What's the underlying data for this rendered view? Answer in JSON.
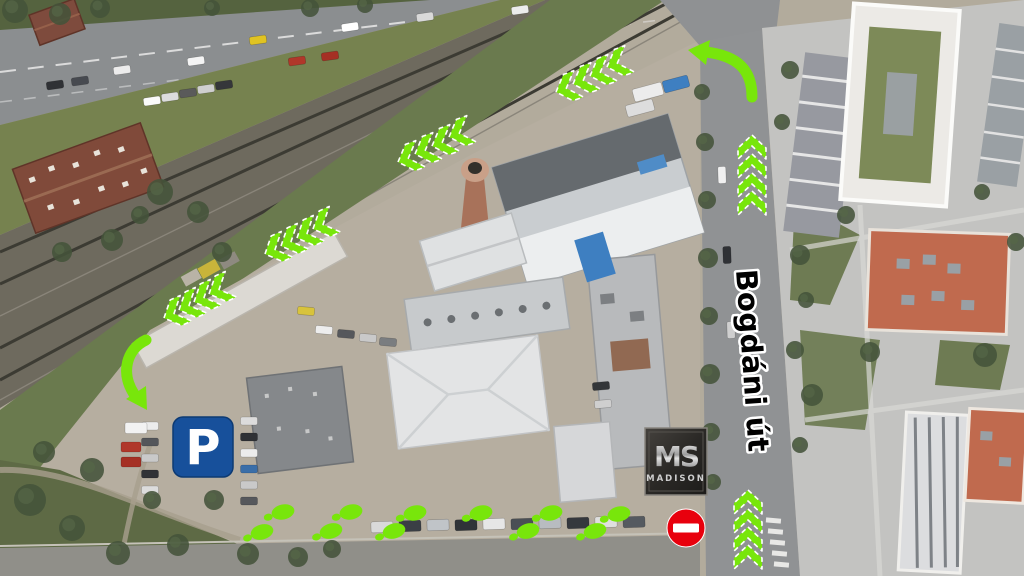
{
  "overlay": {
    "colors": {
      "route_green": "#78e60b",
      "parking_blue": "#17509b",
      "no_entry_red": "#e8000d",
      "street_label_fill": "#000000",
      "street_label_outline": "#ffffff",
      "logo_background": "#2e2c29"
    },
    "street_label": {
      "text": "Bogdáni út"
    },
    "parking_sign": {
      "symbol": "P"
    },
    "madison_logo": {
      "initials": "MS",
      "name": "MADISON"
    },
    "route": {
      "chevron_groups": [
        {
          "name": "railway-route-chevrons-1",
          "rotation": -20,
          "tips": [
            [
              556,
              92
            ],
            [
              573,
              84
            ],
            [
              590,
              76
            ],
            [
              607,
              67
            ]
          ]
        },
        {
          "name": "railway-route-chevrons-2",
          "rotation": -20,
          "tips": [
            [
              398,
              162
            ],
            [
              415,
              154
            ],
            [
              432,
              146
            ],
            [
              449,
              137
            ]
          ]
        },
        {
          "name": "railway-route-chevrons-3",
          "rotation": -24,
          "tips": [
            [
              265,
              254
            ],
            [
              281,
              246
            ],
            [
              297,
              238
            ],
            [
              313,
              229
            ]
          ]
        },
        {
          "name": "railway-route-chevrons-4",
          "rotation": -24,
          "tips": [
            [
              164,
              318
            ],
            [
              179,
              310
            ],
            [
              194,
              302
            ],
            [
              209,
              294
            ]
          ]
        },
        {
          "name": "bogdani-street-chevrons-north",
          "rotation": 90,
          "tips": [
            [
              752,
              135
            ],
            [
              752,
              154
            ],
            [
              752,
              173
            ],
            [
              752,
              191
            ]
          ]
        },
        {
          "name": "bogdani-street-chevrons-south",
          "rotation": 90,
          "tips": [
            [
              748,
              490
            ],
            [
              748,
              509
            ],
            [
              748,
              527
            ],
            [
              748,
              545
            ]
          ]
        }
      ],
      "curved_arrows": [
        {
          "name": "turn-arrow-from-bogdani",
          "path": "M752 97 C752 70 738 56 706 52",
          "head": "688,50 710,40 706,65"
        },
        {
          "name": "turn-arrow-into-parking",
          "path": "M146 340 C127 349 120 372 134 394",
          "head": "147,410 146,386 126,399"
        }
      ],
      "footsteps": [
        [
          262,
          532,
          -15
        ],
        [
          283,
          512,
          -12
        ],
        [
          331,
          531,
          -15
        ],
        [
          351,
          512,
          -12
        ],
        [
          394,
          531,
          -15
        ],
        [
          415,
          513,
          -12
        ],
        [
          481,
          513,
          -12
        ],
        [
          528,
          531,
          -15
        ],
        [
          551,
          513,
          -12
        ],
        [
          595,
          531,
          -15
        ],
        [
          619,
          514,
          -12
        ]
      ]
    }
  }
}
